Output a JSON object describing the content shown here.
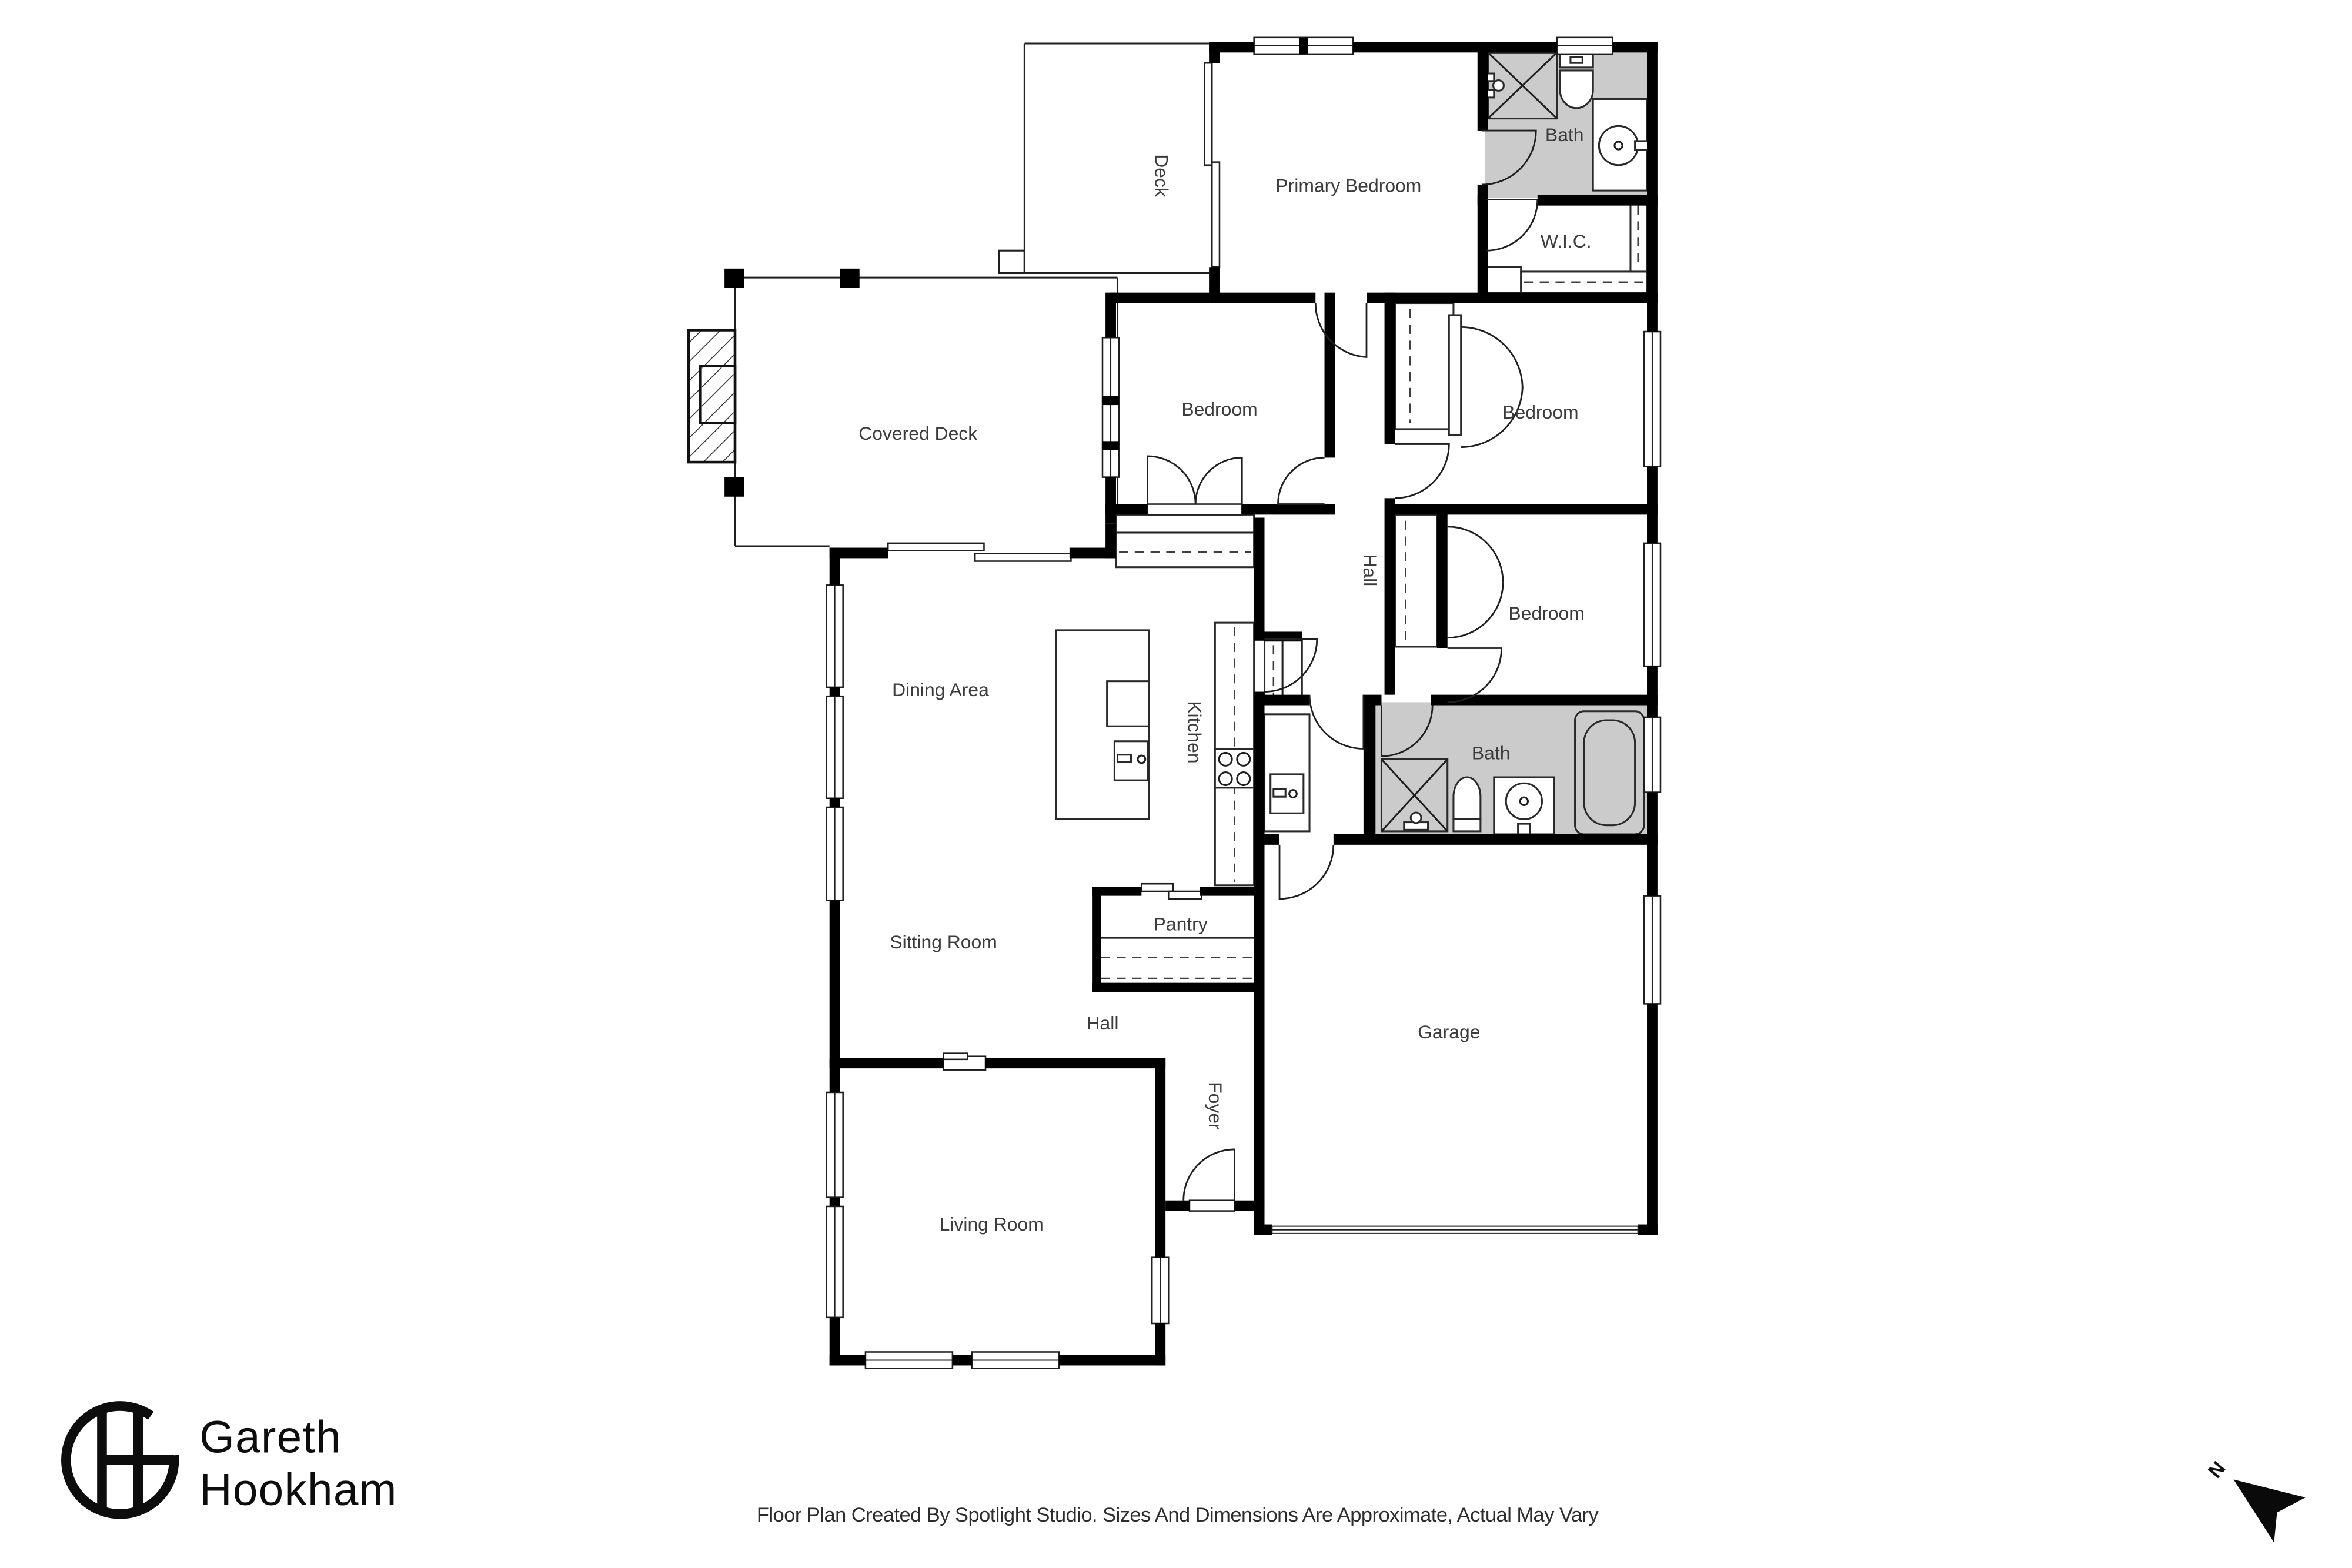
{
  "rooms": {
    "deck": "Deck",
    "primary_bedroom": "Primary Bedroom",
    "bath_upper": "Bath",
    "wic": "W.I.C.",
    "covered_deck": "Covered Deck",
    "bedroom_middle": "Bedroom",
    "bedroom_upper_right": "Bedroom",
    "hall_upper": "Hall",
    "bedroom_lower_right": "Bedroom",
    "dining_area": "Dining Area",
    "kitchen": "Kitchen",
    "sitting_room": "Sitting Room",
    "bath_lower": "Bath",
    "pantry": "Pantry",
    "hall_lower": "Hall",
    "garage": "Garage",
    "foyer": "Foyer",
    "living_room": "Living Room"
  },
  "branding": {
    "name_line1": "Gareth",
    "name_line2": "Hookham"
  },
  "footer": {
    "disclaimer": "Floor Plan Created By Spotlight Studio. Sizes And Dimensions Are Approximate, Actual May Vary"
  },
  "compass": {
    "label": "N"
  },
  "colors": {
    "wall": "#000000",
    "bath_fill": "#cbcbcb"
  }
}
